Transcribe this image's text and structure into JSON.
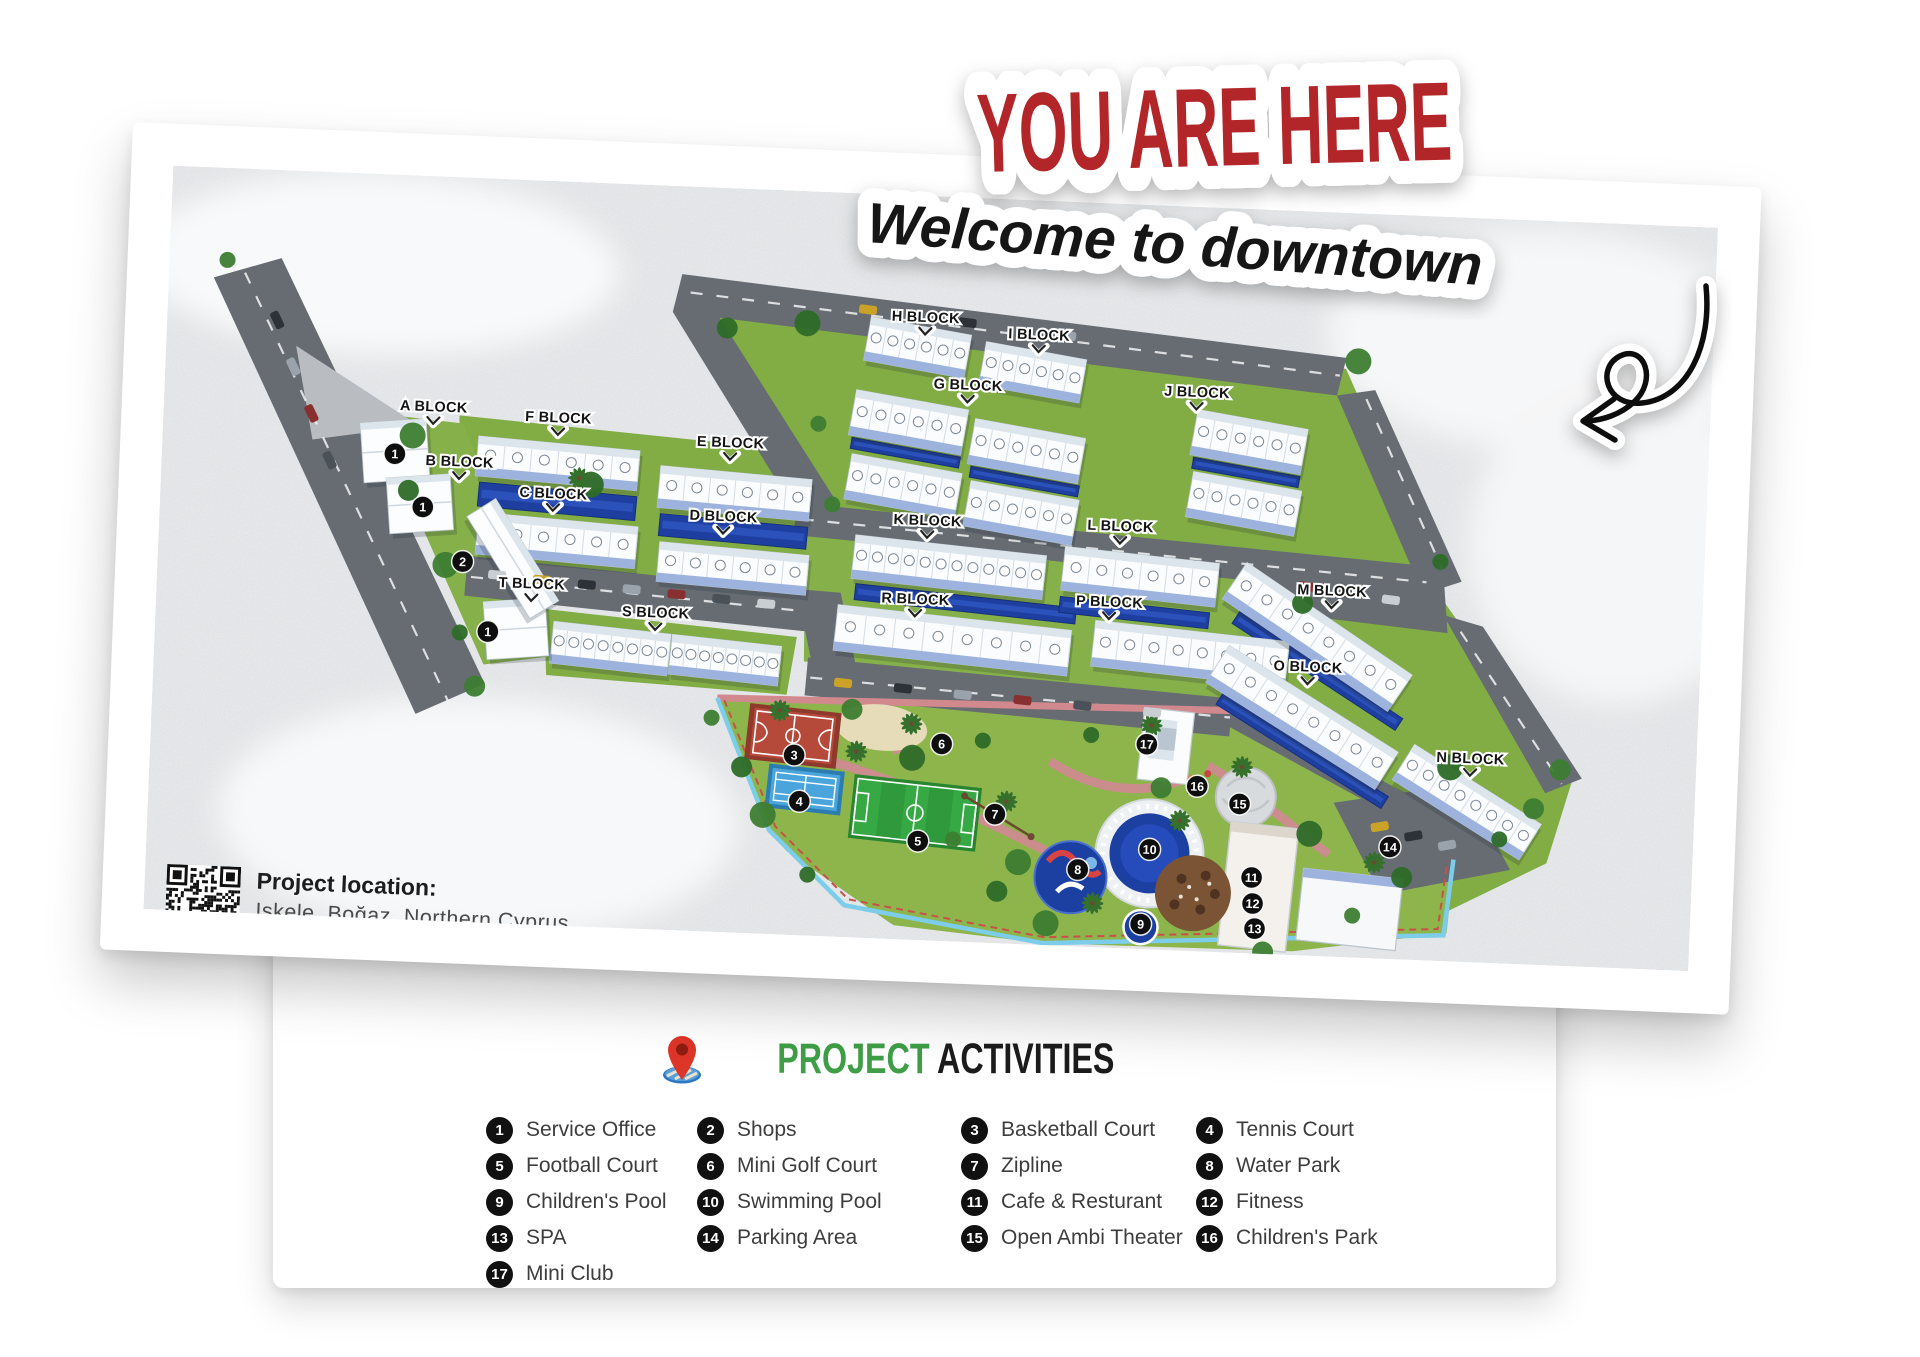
{
  "stickers": {
    "you_are_here": "YOU ARE HERE",
    "welcome": "Welcome to downtown"
  },
  "map": {
    "location_title": "Project location:",
    "location_address": "Iskele, Boğaz, Northern Cyprus",
    "blocks": [
      {
        "label": "A BLOCK",
        "x": 270,
        "y": 235
      },
      {
        "label": "B BLOCK",
        "x": 298,
        "y": 289
      },
      {
        "label": "C BLOCK",
        "x": 393,
        "y": 317
      },
      {
        "label": "D BLOCK",
        "x": 564,
        "y": 333
      },
      {
        "label": "E BLOCK",
        "x": 568,
        "y": 259
      },
      {
        "label": "F BLOCK",
        "x": 395,
        "y": 241
      },
      {
        "label": "G BLOCK",
        "x": 803,
        "y": 192
      },
      {
        "label": "H BLOCK",
        "x": 758,
        "y": 126
      },
      {
        "label": "I BLOCK",
        "x": 872,
        "y": 139
      },
      {
        "label": "J BLOCK",
        "x": 1032,
        "y": 190
      },
      {
        "label": "K BLOCK",
        "x": 768,
        "y": 329
      },
      {
        "label": "L BLOCK",
        "x": 961,
        "y": 327
      },
      {
        "label": "M BLOCK",
        "x": 1175,
        "y": 383
      },
      {
        "label": "N BLOCK",
        "x": 1320,
        "y": 545
      },
      {
        "label": "O BLOCK",
        "x": 1154,
        "y": 460
      },
      {
        "label": "P BLOCK",
        "x": 953,
        "y": 403
      },
      {
        "label": "R BLOCK",
        "x": 759,
        "y": 408
      },
      {
        "label": "S BLOCK",
        "x": 500,
        "y": 432
      },
      {
        "label": "T BLOCK",
        "x": 375,
        "y": 408
      }
    ],
    "amenity_badges": [
      {
        "n": "1",
        "x": 233,
        "y": 279
      },
      {
        "n": "1",
        "x": 263,
        "y": 331
      },
      {
        "n": "1",
        "x": 333,
        "y": 453
      },
      {
        "n": "2",
        "x": 305,
        "y": 384
      },
      {
        "n": "3",
        "x": 644,
        "y": 564
      },
      {
        "n": "4",
        "x": 651,
        "y": 610
      },
      {
        "n": "5",
        "x": 771,
        "y": 645
      },
      {
        "n": "6",
        "x": 791,
        "y": 547
      },
      {
        "n": "7",
        "x": 847,
        "y": 615
      },
      {
        "n": "8",
        "x": 932,
        "y": 667
      },
      {
        "n": "9",
        "x": 997,
        "y": 719
      },
      {
        "n": "10",
        "x": 1003,
        "y": 644
      },
      {
        "n": "11",
        "x": 1106,
        "y": 668
      },
      {
        "n": "12",
        "x": 1108,
        "y": 694
      },
      {
        "n": "13",
        "x": 1111,
        "y": 719
      },
      {
        "n": "14",
        "x": 1243,
        "y": 632
      },
      {
        "n": "15",
        "x": 1091,
        "y": 595
      },
      {
        "n": "16",
        "x": 1048,
        "y": 579
      },
      {
        "n": "17",
        "x": 996,
        "y": 539
      }
    ]
  },
  "legend": {
    "title_green": "PROJECT",
    "title_black": "ACTIVITIES",
    "items": [
      {
        "num": "1",
        "label": "Service Office"
      },
      {
        "num": "2",
        "label": "Shops"
      },
      {
        "num": "3",
        "label": "Basketball Court"
      },
      {
        "num": "4",
        "label": "Tennis Court"
      },
      {
        "num": "5",
        "label": "Football Court"
      },
      {
        "num": "6",
        "label": "Mini Golf Court"
      },
      {
        "num": "7",
        "label": "Zipline"
      },
      {
        "num": "8",
        "label": "Water Park"
      },
      {
        "num": "9",
        "label": "Children's Pool"
      },
      {
        "num": "10",
        "label": "Swimming Pool"
      },
      {
        "num": "11",
        "label": "Cafe & Resturant"
      },
      {
        "num": "12",
        "label": "Fitness"
      },
      {
        "num": "13",
        "label": "SPA"
      },
      {
        "num": "14",
        "label": "Parking Area"
      },
      {
        "num": "15",
        "label": "Open Ambi Theater"
      },
      {
        "num": "16",
        "label": "Children's Park"
      },
      {
        "num": "17",
        "label": "Mini Club"
      }
    ]
  },
  "colors": {
    "red": "#b2252b",
    "green": "#3f9e47",
    "badge_black": "#111111",
    "pool_blue": "#1e3f9f",
    "grass_green": "#83ad45",
    "road_gray": "#666c72"
  }
}
